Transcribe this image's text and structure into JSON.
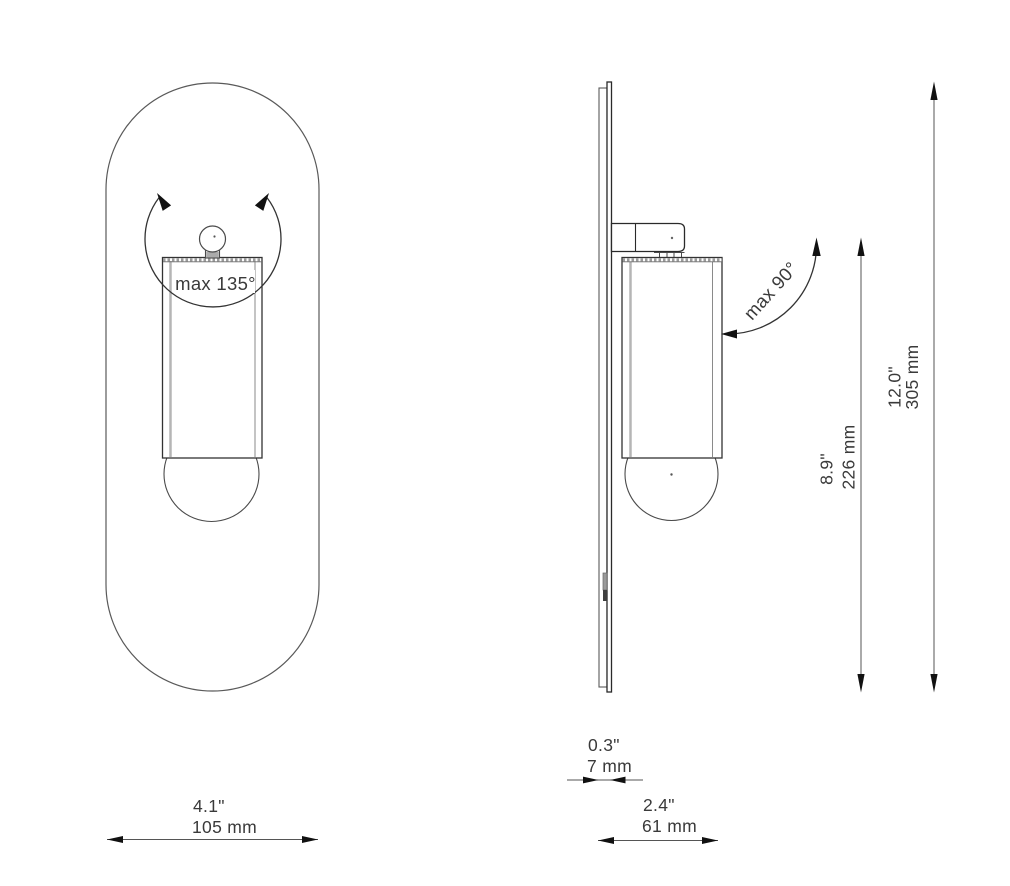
{
  "view_front": {
    "rotation_label": "max 135°"
  },
  "view_side": {
    "rotation_label": "max 90°"
  },
  "dimensions": {
    "width": {
      "in": "4.1\"",
      "mm": "105 mm"
    },
    "plate_depth": {
      "in": "0.3\"",
      "mm": "7 mm"
    },
    "total_depth": {
      "in": "2.4\"",
      "mm": "61 mm"
    },
    "body_height": {
      "in": "8.9\"",
      "mm": "226 mm"
    },
    "total_height": {
      "in": "12.0\"",
      "mm": "305 mm"
    }
  },
  "colors": {
    "line": "#444444",
    "line_dark": "#2a2a2a",
    "line_light": "#b5b5b5",
    "arrow": "#111111",
    "text": "#3a3a3a",
    "background": "#ffffff"
  }
}
